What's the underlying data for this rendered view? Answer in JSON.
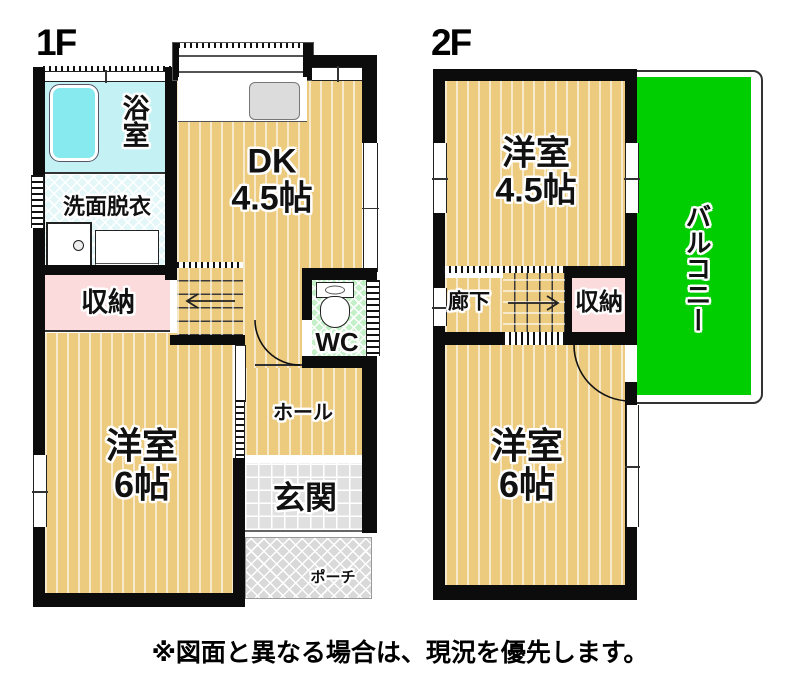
{
  "floor1": {
    "floor_label": "1F",
    "rooms": {
      "bath": "浴室",
      "washroom": "洗面脱衣",
      "dk_line1": "DK",
      "dk_line2": "4.5帖",
      "storage": "収納",
      "wc": "WC",
      "hall": "ホール",
      "bedroom_line1": "洋室",
      "bedroom_line2": "6帖",
      "entrance": "玄関",
      "porch": "ポーチ"
    }
  },
  "floor2": {
    "floor_label": "2F",
    "rooms": {
      "bedroom45_line1": "洋室",
      "bedroom45_line2": "4.5帖",
      "balcony": "バルコニー",
      "corridor": "廊下",
      "storage": "収納",
      "bedroom6_line1": "洋室",
      "bedroom6_line2": "6帖"
    }
  },
  "disclaimer": "※図面と異なる場合は、現況を優先します。",
  "colors": {
    "floor_tan": "#ECCB7F",
    "balcony_green": "#00CE00",
    "wc_green": "#C4F0C8",
    "bath_cyan": "#C4F1F4",
    "storage_pink": "#FBDBDC",
    "wall_black": "#0c0c0c"
  }
}
